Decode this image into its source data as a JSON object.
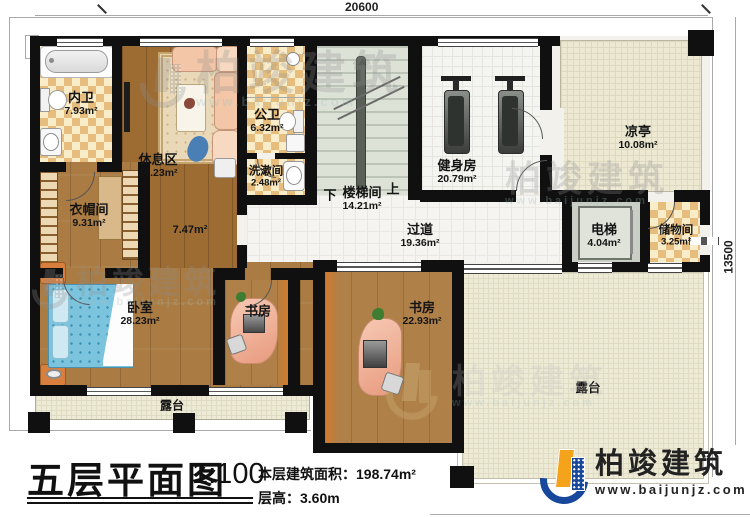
{
  "plan": {
    "dimensions": {
      "top": "20600",
      "right": "13500"
    },
    "stairs": {
      "down": "下",
      "up": "上"
    }
  },
  "rooms": {
    "neiwei": {
      "label": "内卫",
      "area": "7.93m²"
    },
    "xiuxiqu": {
      "label": "休息区",
      "area": "16.23m²"
    },
    "gongwei": {
      "label": "公卫",
      "area": "6.32m²"
    },
    "xishujian": {
      "label": "洗漱间",
      "area": "2.48m²"
    },
    "loutijian": {
      "label": "楼梯间",
      "area": "14.21m²"
    },
    "corridor": {
      "area": "7.47m²"
    },
    "jianshenfang": {
      "label": "健身房",
      "area": "20.79m²"
    },
    "liangting": {
      "label": "凉亭",
      "area": "10.08m²"
    },
    "guodao": {
      "label": "过道",
      "area": "19.36m²"
    },
    "dianti": {
      "label": "电梯",
      "area": "4.04m²"
    },
    "chuwujian": {
      "label": "储物间",
      "area": "3.25m²"
    },
    "yimaojian": {
      "label": "衣帽间",
      "area": "9.31m²"
    },
    "woshi": {
      "label": "卧室",
      "area": "28.23m²"
    },
    "shufang_small": {
      "label": "书房"
    },
    "shufang_large": {
      "label": "书房",
      "area": "22.93m²"
    },
    "lutai_left": {
      "label": "露台"
    },
    "lutai_right": {
      "label": "露台"
    }
  },
  "titleblock": {
    "title": "五层平面图",
    "scale": "1:100",
    "area_label": "本层建筑面积：",
    "area_value": "198.74m²",
    "height_label": "层高：",
    "height_value": "3.60m"
  },
  "brand": {
    "name": "柏竣建筑",
    "site": "www.baijunjz.com"
  },
  "watermark": {
    "name": "柏竣建筑",
    "site": "www.baijunjz.com"
  },
  "colors": {
    "wall": "#101010",
    "brand_blue": "#17489c",
    "brand_orange": "#f6a31c",
    "wood": "#aa7b42",
    "tile_dark": "#e6bd7d",
    "tile_light": "#f8ecc9"
  }
}
